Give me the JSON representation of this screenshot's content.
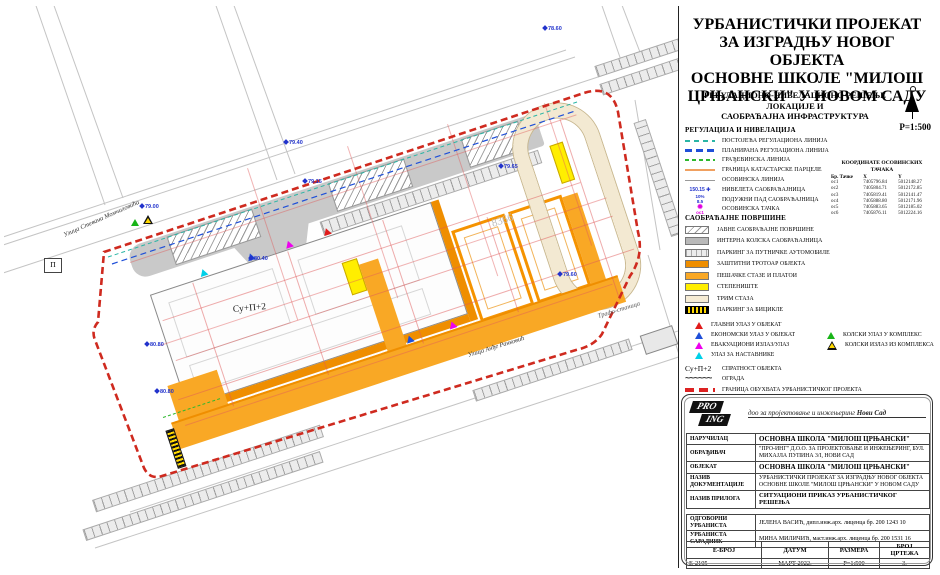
{
  "sheet": {
    "title_lines": [
      "УРБАНИСТИЧКИ ПРОЈЕКАТ",
      "ЗА ИЗГРАДЊУ НОВОГ ОБЈЕКТА",
      "ОСНОВНЕ ШКОЛЕ \"МИЛОШ",
      "ЦРЊАНСКИ\" У НОВОМ САДУ"
    ],
    "subtitle_lines": [
      "РЕГУЛАЦИОНО-НИВЕЛАЦИОНО РЕШЕЊЕ ЛОКАЦИЈЕ И",
      "САОБРАЋАЈНА ИНФРАСТРУКТУРА"
    ],
    "scale": "Р=1:500"
  },
  "legend_regulation": {
    "heading": "РЕГУЛАЦИЈА И НИВЕЛАЦИЈА",
    "items": [
      {
        "label": "ПОСТОЈЕЋА РЕГУЛАЦИОНА ЛИНИЈА"
      },
      {
        "label": "ПЛАНИРАНА РЕГУЛАЦИОНА ЛИНИЈА"
      },
      {
        "label": "ГРАЂЕВИНСКА ЛИНИЈА"
      },
      {
        "label": "ГРАНИЦА КАТАСТАРСКЕ ПАРЦЕЛЕ"
      },
      {
        "label": "ОСОВИНСКА ЛИНИЈА"
      },
      {
        "label": "НИВЕЛЕТА САОБРАЋАЈНИЦА",
        "symbol": "150.15"
      },
      {
        "label": "ПОДУЖНИ ПАД САОБРАЋАЈНИЦА",
        "symbol_top": "10%",
        "symbol_bottom": "8.5"
      },
      {
        "label": "ОСОВИНСКА ТАЧКА",
        "symbol": "ос1"
      }
    ]
  },
  "coord_table": {
    "title": "КООРДИНАТЕ ОСОВИНСКИХ ТАЧАКА",
    "headers": [
      "Бр. Тачке",
      "X",
      "Y"
    ],
    "rows": [
      [
        "ос1",
        "7405796.84",
        "5012148.27"
      ],
      [
        "ос2",
        "7405804.71",
        "5012172.85"
      ],
      [
        "ос3",
        "7405819.41",
        "5012141.47"
      ],
      [
        "ос4",
        "7405888.80",
        "5012171.96"
      ],
      [
        "ос5",
        "7405883.65",
        "5012185.02"
      ],
      [
        "ос6",
        "7405876.11",
        "5012224.16"
      ]
    ]
  },
  "legend_surfaces": {
    "heading": "САОБРАЋАЈНЕ ПОВРШИНЕ",
    "items": [
      {
        "label": "ЈАВНЕ САОБРАЋАЈНЕ ПОВРШИНЕ"
      },
      {
        "label": "ИНТЕРНА КОЛСКА САОБРАЋАЈНИЦА"
      },
      {
        "label": "ПАРКИНГ ЗА ПУТНИЧКЕ АУТОМОБИЛЕ"
      },
      {
        "label": "ЗАШТИТНИ ТРОТОАР ОБЈЕКТА"
      },
      {
        "label": "ПЕШАЧКЕ СТАЗЕ И ПЛАТОИ"
      },
      {
        "label": "СТЕПЕНИШТЕ"
      },
      {
        "label": "ТРИМ СТАЗА"
      },
      {
        "label": "ПАРКИНГ ЗА БИЦИКЛЕ"
      }
    ]
  },
  "legend_entrances": {
    "left": [
      "ГЛАВНИ УЛАЗ У ОБЈЕКАТ",
      "ЕКОНОМСКИ УЛАЗ У ОБЈЕКАТ",
      "ЕВАКУАЦИОНИ ИЗЛАЗ/УЛАЗ",
      "УЛАЗ ЗА НАСТАВНИКЕ"
    ],
    "right": [
      "КОЛСКИ УЛАЗ У КОМПЛЕКС",
      "КОЛСКИ ИЗЛАЗ ИЗ КОМПЛЕКСА"
    ]
  },
  "legend_other": {
    "floors_symbol": "Су+П+2",
    "floors_label": "СПРАТНОСТ ОБЈЕКТА",
    "fence_symbol": "~~~~~~",
    "fence_label": "ОГРАДА",
    "boundary_label": "ГРАНИЦА ОБУХВАТА УРБАНИСТИЧКОГ ПРОЈЕКТА"
  },
  "logo": {
    "pro": "PRO",
    "ing": "ING",
    "tagline": "доо за пројектовање и инжењеринг",
    "tagline_city": "Нови Сад"
  },
  "info_table": {
    "rows": [
      {
        "label": "НАРУЧИЛАЦ",
        "value": "ОСНОВНА ШКОЛА \"МИЛОШ ЦРЊАНСКИ\""
      },
      {
        "label": "ОБРАЂИВАЧ",
        "value": "\"ПРО-ИНГ\" Д.О.О. ЗА ПРОЈЕКТОВАЊЕ И ИНЖЕЊЕРИНГ, БУЛ. МИХАЈЛА ПУПИНА 3/I, НОВИ САД"
      },
      {
        "label": "ОБЈЕКАТ",
        "value": "ОСНОВНА ШКОЛА \"МИЛОШ ЦРЊАНСКИ\""
      },
      {
        "label": "НАЗИВ ДОКУМЕНТАЦИЈЕ",
        "value": "УРБАНИСТИЧКИ ПРОЈЕКАТ ЗА ИЗГРАДЊУ НОВОГ ОБЈЕКТА ОСНОВНЕ ШКОЛЕ \"МИЛОШ ЦРЊАНСКИ\" У НОВОМ САДУ"
      },
      {
        "label": "НАЗИВ ПРИЛОГА",
        "value": "СИТУАЦИОНИ ПРИКАЗ УРБАНИСТИЧКОГ РЕШЕЊА"
      },
      {
        "label": "ОДГОВОРНИ УРБАНИСТА",
        "value": "ЈЕЛЕНА ВАСИЋ, дипл.инж.арх. лиценца бр. 200 1243 10"
      },
      {
        "label": "УРБАНИСТА САРАДНИК",
        "value": "МИНА МИЛИЧИЋ, маст.инж.арх. лиценца бр. 200 1531 16"
      }
    ]
  },
  "footer_table": {
    "headers": [
      "Е-БРОЈ",
      "ДАТУМ",
      "РАЗМЕРА",
      "БРОЈ ЦРТЕЖА"
    ],
    "values": [
      "Е-2105",
      "МАРТ 2022.",
      "Р=1:500",
      "3."
    ]
  },
  "map": {
    "street_momcilovica": "Улица Стевана Момчиловића",
    "street_rankovic": "Улица Анђе Ранковић",
    "trafo": "Трафо-станица",
    "parcel_number": "8366",
    "floors": "Су+П+2",
    "p_box": "П",
    "elevations": [
      "78.60",
      "79.40",
      "79.00",
      "79.15",
      "80.40",
      "80.80",
      "80.80",
      "79.65",
      "79.60"
    ]
  },
  "colors": {
    "boundary_red": "#cf2a1f",
    "existing_reg_teal": "#2ab5a5",
    "planned_reg_blue": "#1f4fd8",
    "building_line_green": "#2eb82e",
    "cadastral_orange": "#f0a060",
    "protective_sidewalk": "#ef8e00",
    "pedestrian_orange": "#f9a825",
    "stairs_yellow": "#ffee00",
    "trim_track_cream": "#f3e9d2",
    "internal_road_gray": "#c9c9c9",
    "axis_point_magenta": "#e000e0",
    "level_blue": "#2233cc"
  }
}
